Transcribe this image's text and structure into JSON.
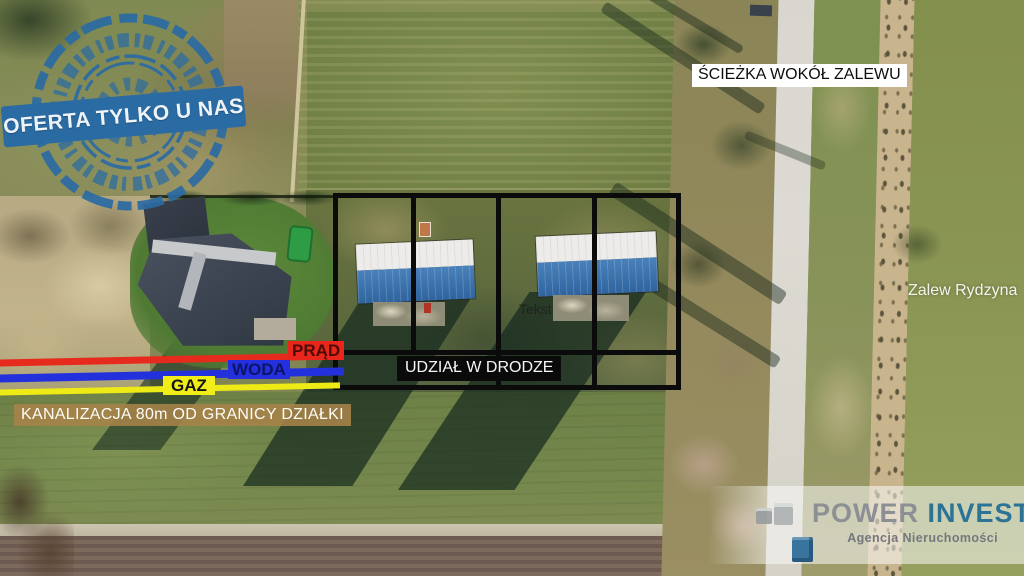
{
  "overlay": {
    "stamp_text": "OFERTA TYLKO U NAS",
    "stamp_color": "#2b6ba3",
    "path_label": "ŚCIEŻKA WOKÓŁ ZALEWU",
    "lagoon_label": "Zalew Rydzyna",
    "road_share_label": "UDZIAŁ W DRODZE",
    "placeholder_label": "Tekst",
    "sewage_label": "KANALIZACJA 80m OD GRANICY DZIAŁKI",
    "utilities": [
      {
        "name": "electricity",
        "label": "PRĄD",
        "line_color": "#e62a1d",
        "label_text_color": "#4e0b05"
      },
      {
        "name": "water",
        "label": "WODA",
        "line_color": "#2331dc",
        "label_text_color": "#0c1468"
      },
      {
        "name": "gas",
        "label": "GAZ",
        "line_color": "#edea16",
        "label_text_color": "#141414"
      }
    ],
    "plot_outline_color": "#0b0b0b"
  },
  "branding": {
    "brand_name_primary": "POWER",
    "brand_name_secondary": "INVEST",
    "brand_subtitle": "Agencja Nieruchomości",
    "brand_primary_color": "#8c9094",
    "brand_secondary_color": "#2d7396"
  },
  "icons": {
    "stamp": "circular-rubber-seal",
    "logo": "isometric-cubes"
  }
}
